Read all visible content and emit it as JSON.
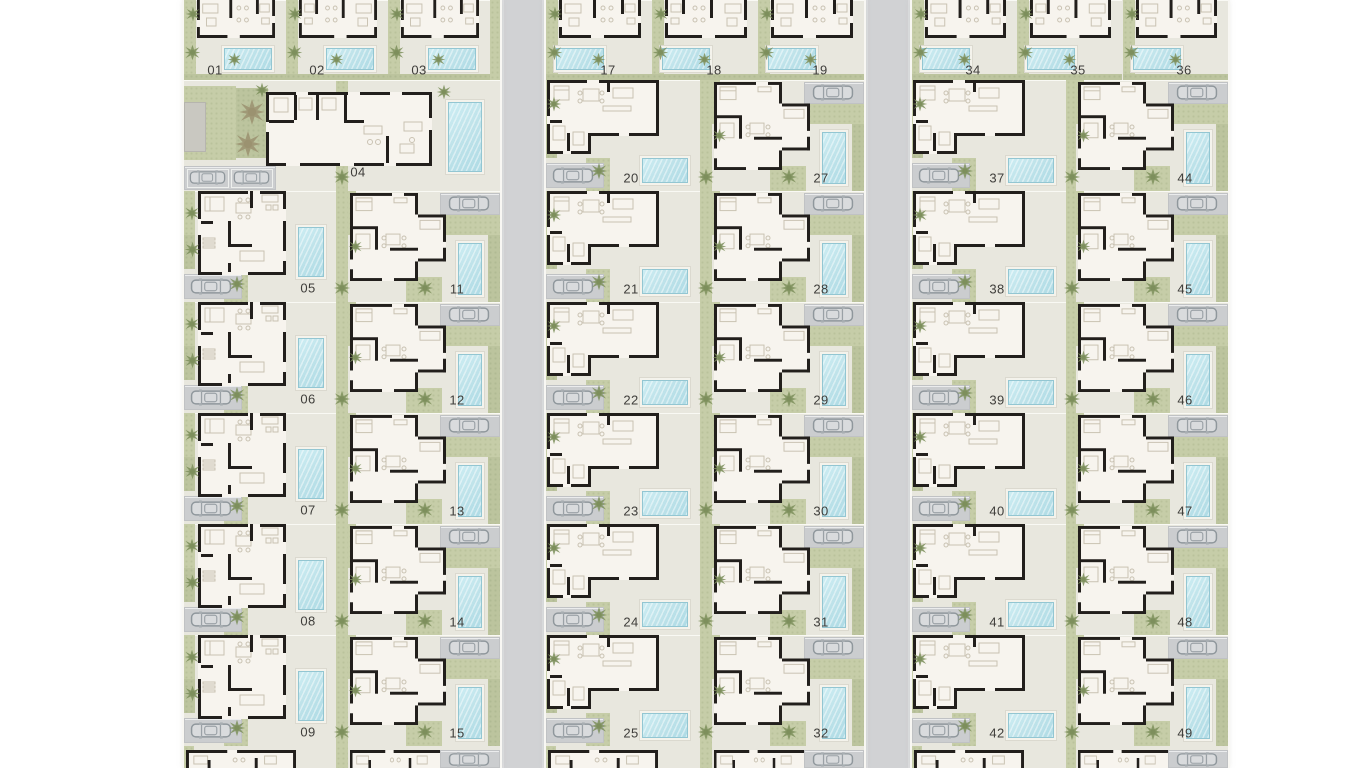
{
  "site": {
    "description_label": "",
    "blocks": [
      {
        "id": "west",
        "top_row": [
          "01",
          "02",
          "03"
        ],
        "clubhouse_label": "04",
        "left_col": [
          "05",
          "06",
          "07",
          "08",
          "09"
        ],
        "right_col": [
          "11",
          "12",
          "13",
          "14",
          "15"
        ]
      },
      {
        "id": "center",
        "top_row": [
          "17",
          "18",
          "19"
        ],
        "left_col": [
          "20",
          "21",
          "22",
          "23",
          "24",
          "25"
        ],
        "right_col": [
          "27",
          "28",
          "29",
          "30",
          "31",
          "32"
        ]
      },
      {
        "id": "east",
        "top_row": [
          "34",
          "35",
          "36"
        ],
        "left_col": [
          "37",
          "38",
          "39",
          "40",
          "41",
          "42"
        ],
        "right_col": [
          "44",
          "45",
          "46",
          "47",
          "48",
          "49"
        ]
      }
    ]
  },
  "colors": {
    "page_bg": "#ffffff",
    "ground": "#e8e7de",
    "garden": "#c6cda8",
    "garden_dark": "#bcc49e",
    "pool_water": "#bfe3ea",
    "pool_deck": "#f4f3ec",
    "road": "#d1d2d4",
    "driveway": "#cbcdcf",
    "wall": "#221f1c",
    "floor": "#f7f4ee",
    "furniture": "#c9c2b2",
    "label_text": "#3e3d3a",
    "tree": "#7d8f5c",
    "palm_tree": "#9b9270",
    "utility_building": "#c9c8c1",
    "curb": "#f8f7f3"
  },
  "icons": {
    "tree_icon": "star-blob",
    "palm_tree_icon": "star-blob-large",
    "car_icon": "rounded-rect-top-view"
  }
}
